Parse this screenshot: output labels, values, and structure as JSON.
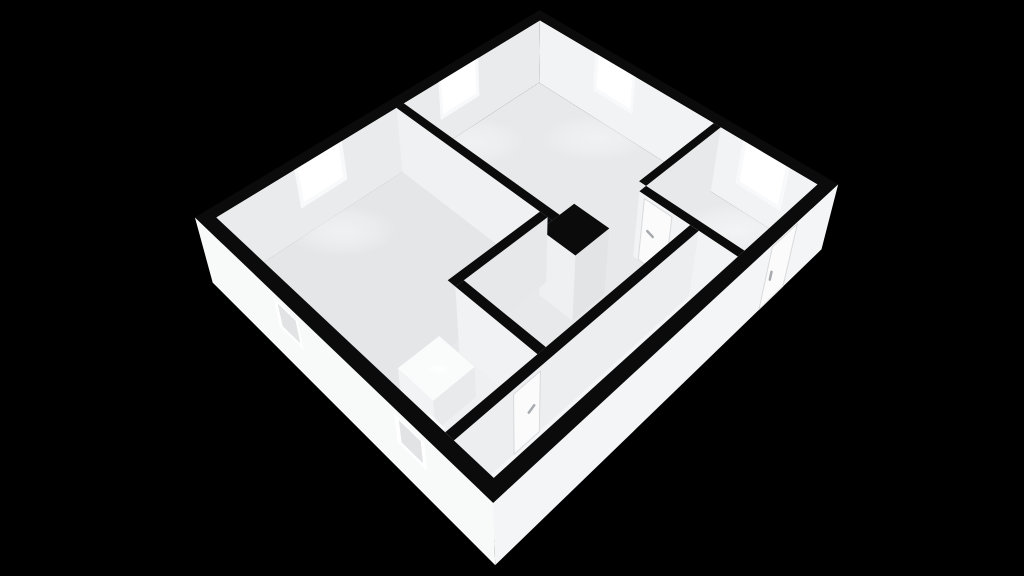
{
  "app": {
    "title": "3d-floorplan-render",
    "background": "#000000"
  },
  "palette": {
    "bg": "#000000",
    "wallTop": "#0b0b0b",
    "floorMain": "#e7e9ea",
    "floorLiving": "#e4e6e8",
    "floorCorridor": "#f4f5f6",
    "floorBath": "#eef0f1",
    "wallIntWest": "#e9ebec",
    "wallIntNorth": "#f2f3f4",
    "wallASouth": "#f0f1f2",
    "chimneySouth": "#eff0f1",
    "chimneyEast": "#e2e4e6",
    "wallDEast": "#e6e8ea",
    "bathNSouth": "#f1f2f3",
    "entryWEast": "#e7e9eb",
    "wallCSouth": "#f2f3f4",
    "corridorEast": "#eceef0",
    "outerSouth": "#f8f9f9",
    "outerEast": "#f4f5f6",
    "glass": "#ffffff",
    "frame": "#f8f9fa",
    "recess": "#e2e3e5",
    "doorLeaf": "#fbfbfb",
    "doorStroke": "#d8dadc",
    "handle": "#a7abaf",
    "fixtureTop": "#fafbfb",
    "fixtureSideE": "#e8eaec",
    "fixtureSideS": "#f2f3f4"
  },
  "camera": {
    "pos": [
      17.8,
      18.58,
      18.2
    ],
    "fwd": [
      -0.512,
      -0.513,
      -0.688
    ],
    "right": [
      0.708,
      -0.706,
      0.0
    ],
    "down": [
      0.486,
      0.487,
      -0.725
    ],
    "fx": 1027.4,
    "fy": 1120.0,
    "cx": 521.9,
    "cy": 234.0
  },
  "building": {
    "width": 10.0,
    "depth": 11.5,
    "wall_cut_height": 2.0,
    "ext_thickness": 0.35
  },
  "rooms": [
    {
      "id": "bedroom-large",
      "label": "bedroom-large"
    },
    {
      "id": "living-room",
      "label": "living-room"
    },
    {
      "id": "entry-room",
      "label": "entry-room"
    },
    {
      "id": "hallway",
      "label": "hallway"
    },
    {
      "id": "corridor",
      "label": "corridor"
    },
    {
      "id": "bathroom",
      "label": "bathroom"
    }
  ],
  "scene": {
    "items": [
      {
        "name": "floor-main",
        "type": "top",
        "r": [
          0.35,
          0.35,
          9.65,
          11.15
        ],
        "z": 0,
        "color": "floorMain"
      },
      {
        "name": "floor-living",
        "type": "top",
        "r": [
          0.35,
          5.7,
          5.55,
          11.15
        ],
        "z": 0,
        "color": "floorLiving"
      },
      {
        "name": "floor-corridor",
        "type": "top",
        "r": [
          8.55,
          3.55,
          9.65,
          11.15
        ],
        "z": 0,
        "color": "floorCorridor"
      },
      {
        "name": "floor-bathroom",
        "type": "top",
        "r": [
          5.8,
          8.6,
          8.3,
          11.15
        ],
        "z": 0,
        "color": "floorBath"
      },
      {
        "name": "window-a-lightpool",
        "type": "glow",
        "at": [
          0.9,
          8.2,
          0
        ],
        "rx": 55,
        "ry": 26,
        "opacity": 0.45
      },
      {
        "name": "window-b-lightpool",
        "type": "glow",
        "at": [
          0.9,
          3.5,
          0
        ],
        "rx": 50,
        "ry": 24,
        "opacity": 0.4
      },
      {
        "name": "window-c-lightpool",
        "type": "glow",
        "at": [
          3.2,
          0.95,
          0
        ],
        "rx": 55,
        "ry": 24,
        "opacity": 0.4
      },
      {
        "name": "window-d-lightpool",
        "type": "glow",
        "at": [
          8.1,
          1.0,
          0
        ],
        "rx": 60,
        "ry": 28,
        "opacity": 0.5
      },
      {
        "name": "northwest-wall-face",
        "type": "faceX",
        "x": 0.35,
        "y": [
          0.35,
          11.15
        ],
        "zr": [
          0,
          2
        ],
        "color": "wallIntWest"
      },
      {
        "name": "window-a-frame",
        "type": "faceX",
        "x": 0.34,
        "y": [
          7.47,
          8.93
        ],
        "zr": [
          0.82,
          2.0
        ],
        "color": "frame"
      },
      {
        "name": "window-a-glass",
        "type": "faceX",
        "x": 0.33,
        "y": [
          7.58,
          8.82
        ],
        "zr": [
          0.95,
          2.0
        ],
        "color": "glass"
      },
      {
        "name": "window-b-frame",
        "type": "faceX",
        "x": 0.34,
        "y": [
          2.77,
          4.23
        ],
        "zr": [
          0.82,
          2.0
        ],
        "color": "frame"
      },
      {
        "name": "window-b-glass",
        "type": "faceX",
        "x": 0.33,
        "y": [
          2.88,
          4.12
        ],
        "zr": [
          0.95,
          2.0
        ],
        "color": "glass"
      },
      {
        "name": "north-wall-face",
        "type": "faceY",
        "yy": 0.35,
        "x": [
          0.35,
          9.65
        ],
        "zr": [
          0,
          2
        ],
        "color": "wallIntNorth"
      },
      {
        "name": "window-c-frame",
        "type": "faceY",
        "yy": 0.34,
        "x": [
          2.47,
          3.93
        ],
        "zr": [
          0.82,
          2.0
        ],
        "color": "frame"
      },
      {
        "name": "window-c-glass",
        "type": "faceY",
        "yy": 0.33,
        "x": [
          2.58,
          3.82
        ],
        "zr": [
          0.95,
          2.0
        ],
        "color": "glass"
      },
      {
        "name": "window-d-frame",
        "type": "faceY",
        "yy": 0.34,
        "x": [
          7.45,
          8.85
        ],
        "zr": [
          0.68,
          2.0
        ],
        "color": "frame"
      },
      {
        "name": "window-d-glass",
        "type": "faceY",
        "yy": 0.33,
        "x": [
          7.56,
          8.74
        ],
        "zr": [
          0.8,
          2.0
        ],
        "color": "glass"
      },
      {
        "name": "northwest-wall-top",
        "type": "top",
        "r": [
          0,
          0,
          0.35,
          11.5
        ],
        "z": 2,
        "color": "wallTop"
      },
      {
        "name": "north-wall-top",
        "type": "top",
        "r": [
          0,
          0,
          10,
          0.35
        ],
        "z": 2,
        "color": "wallTop"
      },
      {
        "name": "wall-a-face",
        "type": "faceY",
        "yy": 5.7,
        "x": [
          0.35,
          5.95
        ],
        "zr": [
          0,
          2
        ],
        "color": "wallASouth"
      },
      {
        "name": "wall-a-top",
        "type": "top",
        "r": [
          0.35,
          5.45,
          5.95,
          5.7
        ],
        "z": 2,
        "color": "wallTop"
      },
      {
        "name": "chimney-face-east",
        "type": "faceX",
        "x": 7.05,
        "y": [
          4.95,
          6.1
        ],
        "zr": [
          0,
          2
        ],
        "color": "chimneyEast"
      },
      {
        "name": "chimney-face-south",
        "type": "faceY",
        "yy": 6.1,
        "x": [
          5.95,
          7.05
        ],
        "zr": [
          0,
          2
        ],
        "color": "chimneySouth"
      },
      {
        "name": "chimney-top",
        "type": "top",
        "r": [
          5.95,
          4.95,
          7.05,
          6.1
        ],
        "z": 2,
        "color": "wallTop"
      },
      {
        "name": "wall-d-top-filler",
        "type": "top",
        "r": [
          5.8,
          5.7,
          5.95,
          6.1
        ],
        "z": 2,
        "color": "wallTop"
      },
      {
        "name": "wall-d-face",
        "type": "faceX",
        "x": 5.8,
        "y": [
          5.7,
          8.6
        ],
        "zr": [
          0,
          2
        ],
        "color": "wallDEast"
      },
      {
        "name": "wall-d-top",
        "type": "top",
        "r": [
          5.55,
          5.7,
          5.8,
          8.6
        ],
        "z": 2,
        "color": "wallTop"
      },
      {
        "name": "bathroom-north-wall-face",
        "type": "faceY",
        "yy": 8.6,
        "x": [
          5.8,
          8.3
        ],
        "zr": [
          0,
          2
        ],
        "color": "bathNSouth"
      },
      {
        "name": "bathroom-north-wall-top",
        "type": "top",
        "r": [
          5.8,
          8.35,
          8.3,
          8.6
        ],
        "z": 2,
        "color": "wallTop"
      },
      {
        "name": "bathroom-vanity",
        "type": "box",
        "r": [
          5.8,
          9.15,
          6.95,
          10.35
        ],
        "z": 0.95,
        "colors": [
          "fixtureTop",
          "fixtureSideE",
          "fixtureSideS"
        ]
      },
      {
        "name": "bathroom-sink",
        "type": "glow",
        "at": [
          6.45,
          9.75,
          0.96
        ],
        "rx": 12,
        "ry": 6,
        "opacity": 0.9
      },
      {
        "name": "bathroom-toilet",
        "type": "box",
        "r": [
          6.95,
          10.5,
          7.5,
          11.15
        ],
        "z": 0.72,
        "colors": [
          "fixtureTop",
          "fixtureSideE",
          "fixtureSideS"
        ]
      },
      {
        "name": "entry-west-wall-face",
        "type": "faceX",
        "x": 6.77,
        "y": [
          0.35,
          3.3
        ],
        "zr": [
          0,
          2
        ],
        "color": "entryWEast"
      },
      {
        "name": "entry-west-wall-top",
        "type": "top",
        "r": [
          6.55,
          0.35,
          6.77,
          3.3
        ],
        "z": 2,
        "color": "wallTop"
      },
      {
        "name": "wall-c-face",
        "type": "faceY",
        "yy": 3.55,
        "x": [
          6.77,
          9.65
        ],
        "zr": [
          0,
          2
        ],
        "color": "wallCSouth"
      },
      {
        "name": "hall-door-leaf",
        "type": "faceY",
        "yy": 3.54,
        "x": [
          6.93,
          7.77
        ],
        "zr": [
          0,
          1.88
        ],
        "color": "doorLeaf",
        "stroke": "doorStroke",
        "sw": 1
      },
      {
        "name": "hall-door-handle",
        "type": "line",
        "a": [
          7.1,
          3.52,
          1.0
        ],
        "b": [
          7.28,
          3.52,
          0.94
        ],
        "w": 2.5,
        "color": "handle"
      },
      {
        "name": "wall-c-top",
        "type": "top",
        "r": [
          6.77,
          3.3,
          9.65,
          3.55
        ],
        "z": 2,
        "color": "wallTop"
      },
      {
        "name": "corridor-west-wall-face",
        "type": "faceX",
        "x": 8.55,
        "y": [
          3.55,
          11.15
        ],
        "zr": [
          0,
          2
        ],
        "color": "corridorEast"
      },
      {
        "name": "bathroom-door-leaf",
        "type": "faceX",
        "x": 8.56,
        "y": [
          8.78,
          9.55
        ],
        "zr": [
          0,
          1.88
        ],
        "color": "doorLeaf",
        "stroke": "doorStroke",
        "sw": 1
      },
      {
        "name": "bathroom-door-handle",
        "type": "line",
        "a": [
          8.57,
          8.96,
          1.02
        ],
        "b": [
          8.57,
          9.12,
          0.94
        ],
        "w": 2.5,
        "color": "handle"
      },
      {
        "name": "corridor-west-wall-top",
        "type": "top",
        "r": [
          8.3,
          3.55,
          8.55,
          11.15
        ],
        "z": 2,
        "color": "wallTop"
      },
      {
        "name": "southwest-wall-outer-face",
        "type": "faceY",
        "yy": 11.5,
        "x": [
          0,
          10
        ],
        "zr": [
          0,
          2
        ],
        "color": "outerSouth"
      },
      {
        "name": "southwest-window-1-frame",
        "type": "faceY",
        "yy": 11.49,
        "x": [
          3.05,
          3.95
        ],
        "zr": [
          0.92,
          1.8
        ],
        "color": "glass"
      },
      {
        "name": "southwest-window-1-recess",
        "type": "faceY",
        "yy": 11.48,
        "x": [
          3.17,
          3.83
        ],
        "zr": [
          1.02,
          1.7
        ],
        "color": "recess"
      },
      {
        "name": "southwest-window-2-frame",
        "type": "faceY",
        "yy": 11.49,
        "x": [
          7.15,
          8.05
        ],
        "zr": [
          0.92,
          1.8
        ],
        "color": "glass"
      },
      {
        "name": "southwest-window-2-recess",
        "type": "faceY",
        "yy": 11.48,
        "x": [
          7.27,
          7.93
        ],
        "zr": [
          1.02,
          1.7
        ],
        "color": "recess"
      },
      {
        "name": "southwest-wall-top",
        "type": "top",
        "r": [
          0,
          11.15,
          10,
          11.5
        ],
        "z": 2,
        "color": "wallTop"
      },
      {
        "name": "east-wall-outer-face",
        "type": "faceX",
        "x": 10,
        "y": [
          0,
          11.5
        ],
        "zr": [
          0,
          2
        ],
        "color": "outerEast"
      },
      {
        "name": "front-door-leaf",
        "type": "faceX",
        "x": 10.01,
        "y": [
          1.72,
          2.72
        ],
        "zr": [
          0.04,
          1.95
        ],
        "color": "doorLeaf",
        "stroke": "doorStroke",
        "sw": 1
      },
      {
        "name": "front-door-handle",
        "type": "line",
        "a": [
          10.02,
          2.52,
          1.08
        ],
        "b": [
          10.02,
          2.52,
          0.84
        ],
        "w": 2.5,
        "color": "handle"
      },
      {
        "name": "east-wall-top",
        "type": "top",
        "r": [
          9.65,
          0,
          10,
          11.5
        ],
        "z": 2,
        "color": "wallTop"
      }
    ]
  }
}
